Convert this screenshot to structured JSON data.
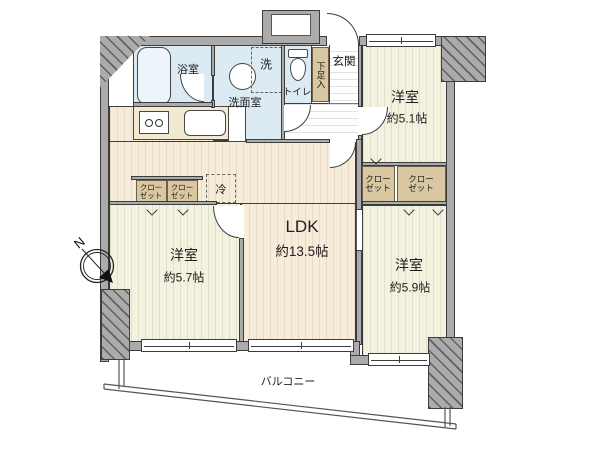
{
  "compass": {
    "north_label": "N"
  },
  "colors": {
    "wall": "#ababab",
    "water": "#dcebf3",
    "closet": "#d8c7a0",
    "ldk": "#f7ecda",
    "bedroom": "#f3f1df",
    "outline": "#3c3c3c",
    "counter": "#f3e8d0"
  },
  "rooms": {
    "bath": {
      "name": "浴室"
    },
    "washroom": {
      "name": "洗面室"
    },
    "laundry": {
      "name": "洗"
    },
    "toilet": {
      "name": "トイレ"
    },
    "shoe_cabinet": {
      "name": "下足入"
    },
    "entrance": {
      "name": "玄関"
    },
    "refrigerator": {
      "name": "冷"
    },
    "ldk": {
      "name": "LDK",
      "size": "約13.5帖"
    },
    "bedroom_left": {
      "name": "洋室",
      "size": "約5.7帖"
    },
    "bedroom_top_right": {
      "name": "洋室",
      "size": "約5.1帖"
    },
    "bedroom_bottom_right": {
      "name": "洋室",
      "size": "約5.9帖"
    },
    "closet": {
      "label": "クロー\nゼット"
    },
    "balcony": {
      "name": "バルコニー"
    }
  }
}
